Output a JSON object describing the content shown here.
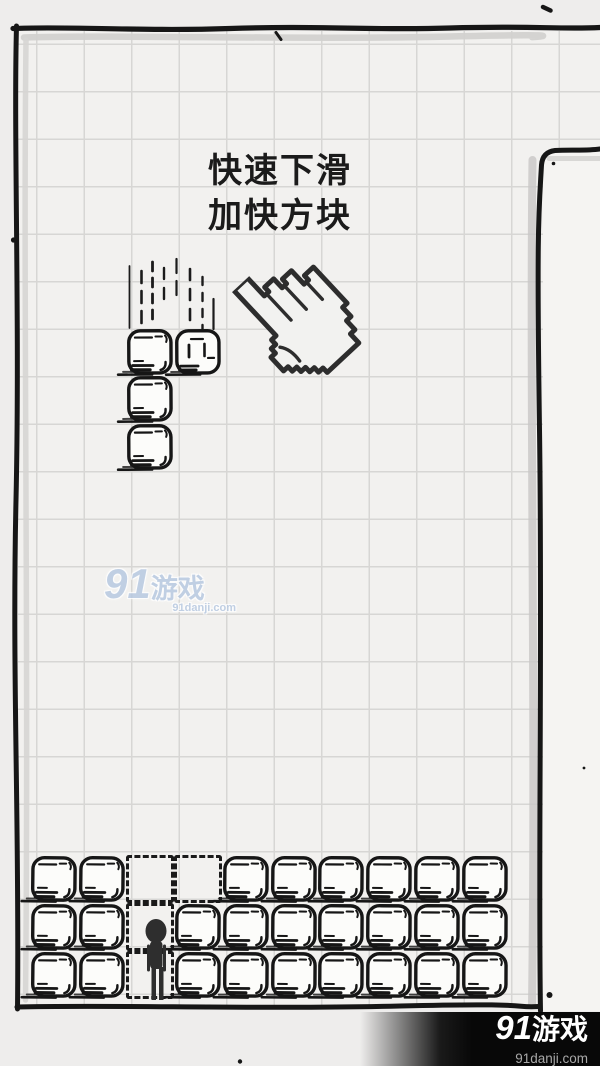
{
  "screen": {
    "width": 600,
    "height": 1066,
    "background": "#eeedec"
  },
  "tutorial": {
    "line1": "快速下滑",
    "line2": "加快方块"
  },
  "board": {
    "columns": 10,
    "cell_size": 47.9,
    "origin_x": 30,
    "stack_origin_y": 854.8,
    "falling_piece": {
      "shape": "J",
      "origin_y": 327.5,
      "cells": [
        {
          "col": 3,
          "row": 1,
          "variant": 0
        },
        {
          "col": 4,
          "row": 1,
          "variant": 1
        },
        {
          "col": 3,
          "row": 2,
          "variant": 0
        },
        {
          "col": 3,
          "row": 3,
          "variant": 0
        }
      ]
    },
    "ghost_cells": [
      {
        "col": 3,
        "row": 1
      },
      {
        "col": 4,
        "row": 1
      },
      {
        "col": 3,
        "row": 2
      },
      {
        "col": 3,
        "row": 3
      }
    ],
    "stack_rows": [
      {
        "row": 1,
        "filled_cols": [
          1,
          2,
          5,
          6,
          7,
          8,
          9,
          10
        ]
      },
      {
        "row": 2,
        "filled_cols": [
          1,
          2,
          4,
          5,
          6,
          7,
          8,
          9,
          10
        ]
      },
      {
        "row": 3,
        "filled_cols": [
          1,
          2,
          4,
          5,
          6,
          7,
          8,
          9,
          10
        ]
      }
    ],
    "character": {
      "type": "stick-figure",
      "col": 3
    }
  },
  "watermark_center": {
    "logo_prefix": "91",
    "logo_suffix": "游戏",
    "site": "91danji.com",
    "color": "#b6c8e1"
  },
  "watermark_corner": {
    "logo_prefix": "91",
    "logo_suffix": "游戏",
    "site": "91danji.com",
    "bar_color": "#080808",
    "text_color": "#ffffff",
    "site_color": "#a8a8a8"
  },
  "colors": {
    "ink": "#161616",
    "block_fill": "#fcfcfa",
    "grid_line": "#d7d6d4",
    "field_bg": "#f2f1ef",
    "panel_bg": "#f5f4f2"
  }
}
